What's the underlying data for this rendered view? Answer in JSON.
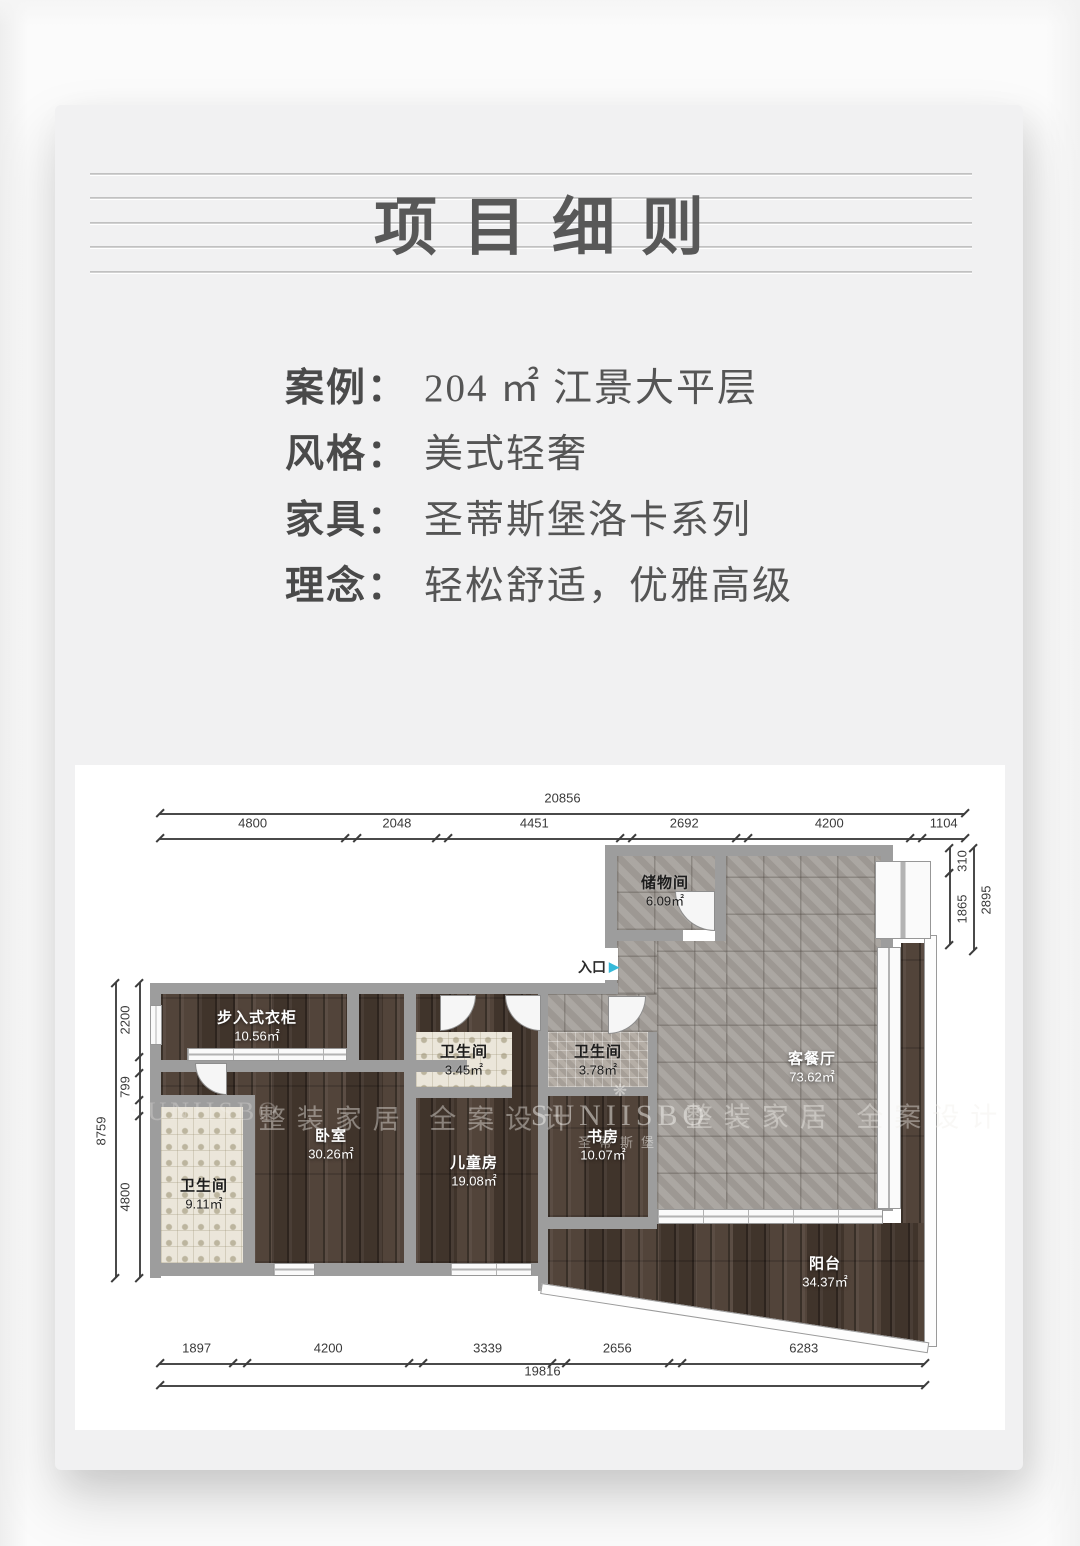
{
  "header": {
    "title": "项目细则"
  },
  "info": {
    "rows": [
      {
        "label": "案例：",
        "value": "204 ㎡ 江景大平层"
      },
      {
        "label": "风格：",
        "value": "美式轻奢"
      },
      {
        "label": "家具：",
        "value": "圣蒂斯堡洛卡系列"
      },
      {
        "label": "理念：",
        "value": "轻松舒适，优雅高级"
      }
    ]
  },
  "floorplan": {
    "entrance": {
      "label": "入口",
      "arrow": "▶",
      "arrow_color": "#35b9d9"
    },
    "rooms": [
      {
        "id": "storage",
        "name": "储物间",
        "area": "6.09㎡"
      },
      {
        "id": "living-dining",
        "name": "客餐厅",
        "area": "73.62㎡"
      },
      {
        "id": "bath-small-1",
        "name": "卫生间",
        "area": "3.45㎡"
      },
      {
        "id": "bath-small-2",
        "name": "卫生间",
        "area": "3.78㎡"
      },
      {
        "id": "walkin-closet",
        "name": "步入式衣柜",
        "area": "10.56㎡"
      },
      {
        "id": "bath-master",
        "name": "卫生间",
        "area": "9.11㎡"
      },
      {
        "id": "bedroom",
        "name": "卧室",
        "area": "30.26㎡"
      },
      {
        "id": "kids-room",
        "name": "儿童房",
        "area": "19.08㎡"
      },
      {
        "id": "study",
        "name": "书房",
        "area": "10.07㎡"
      },
      {
        "id": "balcony",
        "name": "阳台",
        "area": "34.37㎡"
      }
    ],
    "watermarks": {
      "brand_en": "SUNIISBO",
      "brand_cn": "圣蒂斯堡",
      "slogan": "整装家居 全案设计",
      "flower": "❋"
    },
    "dimensions": {
      "top": {
        "total": "20856",
        "segments": [
          "4800",
          "2048",
          "4451",
          "2692",
          "4200",
          "1104"
        ]
      },
      "bottom": {
        "total": "19816",
        "segments": [
          "1897",
          "4200",
          "3339",
          "2656",
          "6283"
        ]
      },
      "left": {
        "total": "8759",
        "segments": [
          "2200",
          "799",
          "4800"
        ]
      },
      "right": {
        "total": "2895",
        "segments": [
          "310",
          "1865"
        ]
      }
    }
  }
}
